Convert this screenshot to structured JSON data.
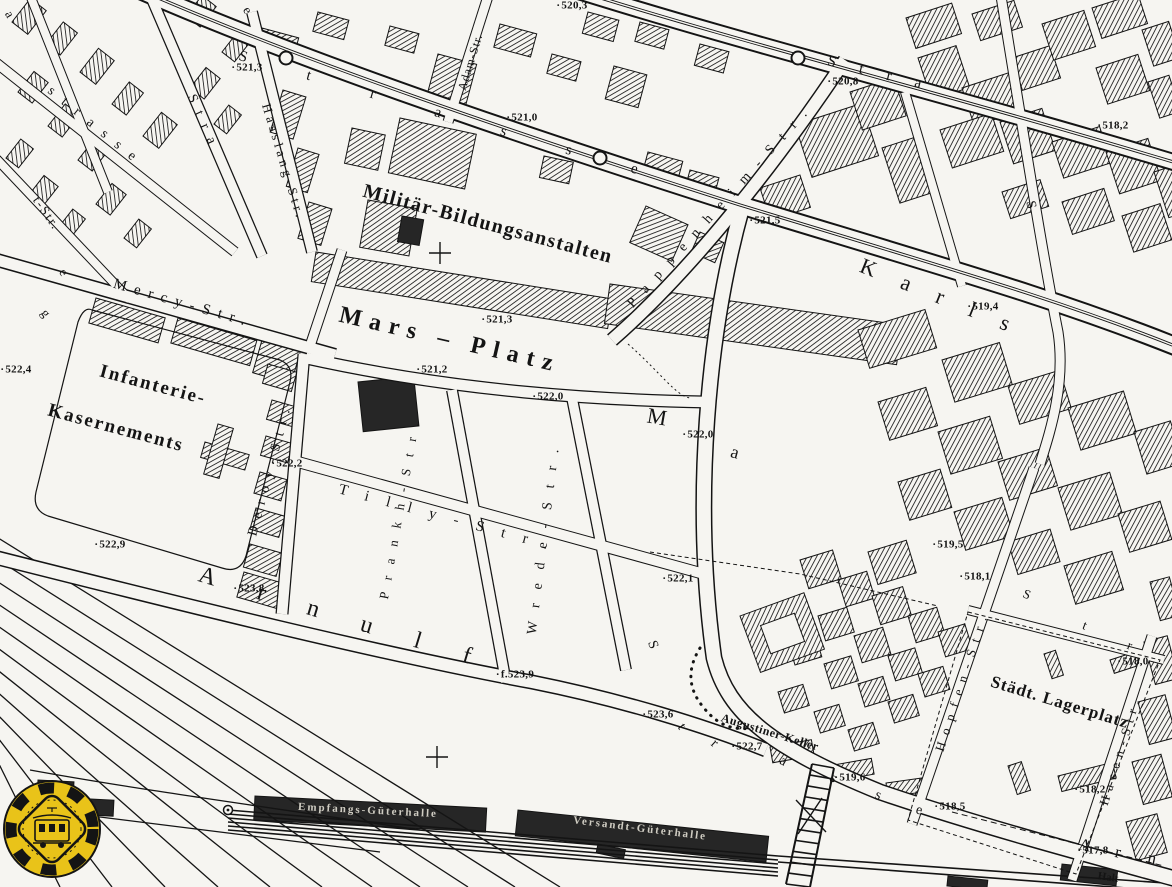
{
  "colors": {
    "paper": "#f6f5f1",
    "ink": "#141414",
    "building_hatch": "#1c1c1c",
    "dark_building": "#262626",
    "logo_yellow": "#e9c319"
  },
  "icons": {
    "badge": "tram-badge-logo",
    "stop": "tram-stop-circle",
    "cross": "cross-marker",
    "bridge": "rail-footbridge"
  },
  "labels": {
    "places": [
      {
        "text": "Militär-Bildungsanstalten",
        "x": 488,
        "y": 224,
        "r": 15,
        "size": 20,
        "sp": 1.5,
        "name": "label-militaer-bildungsanstalten"
      },
      {
        "text": "Mars – Platz",
        "x": 450,
        "y": 340,
        "r": 13,
        "size": 24,
        "sp": 8,
        "name": "label-mars-platz"
      },
      {
        "text": "Infanterie-",
        "x": 153,
        "y": 385,
        "r": 15,
        "size": 19,
        "sp": 2,
        "name": "label-infanterie"
      },
      {
        "text": "Kasernements",
        "x": 116,
        "y": 428,
        "r": 15,
        "size": 19,
        "sp": 2,
        "name": "label-kasernements"
      },
      {
        "text": "Städt. Lagerplatz",
        "x": 1060,
        "y": 702,
        "r": 17,
        "size": 17,
        "sp": 1,
        "name": "label-staedt-lagerplatz"
      },
      {
        "text": "Augustiner-Keller",
        "x": 770,
        "y": 732,
        "r": 17,
        "size": 12,
        "sp": 0.5,
        "name": "label-augustiner-keller"
      },
      {
        "text": "Halt",
        "x": 1108,
        "y": 878,
        "r": 8,
        "size": 11,
        "sp": 0,
        "name": "label-halt"
      }
    ],
    "streets": [
      {
        "text": "Mercy-Str.",
        "x": 183,
        "y": 304,
        "r": 16,
        "size": 15,
        "sp": 8,
        "name": "street-label-mercy-str"
      },
      {
        "text": "Hasslang-Str.",
        "x": 284,
        "y": 162,
        "r": 73,
        "size": 13,
        "sp": 4,
        "name": "street-label-hasslang-str"
      },
      {
        "text": "Adam-Str.",
        "x": 470,
        "y": 62,
        "r": -73,
        "size": 12,
        "sp": 1,
        "name": "street-label-adam-str"
      },
      {
        "text": "Deroy-Str.",
        "x": 271,
        "y": 469,
        "r": -75,
        "size": 14,
        "sp": 8,
        "name": "street-label-deroy-str"
      },
      {
        "text": "Tilly-Str.",
        "x": 452,
        "y": 520,
        "r": 15,
        "size": 15,
        "sp": 18,
        "name": "street-label-tilly-str"
      },
      {
        "text": "Prankh-Str.",
        "x": 400,
        "y": 505,
        "r": -80,
        "size": 13,
        "sp": 12,
        "name": "street-label-prankh-str"
      },
      {
        "text": "Wrede-Str.",
        "x": 545,
        "y": 535,
        "r": -83,
        "size": 14,
        "sp": 14,
        "name": "street-label-wrede-str"
      },
      {
        "text": "Pappenheim-Str.",
        "x": 722,
        "y": 205,
        "r": -48,
        "size": 14,
        "sp": 12,
        "name": "street-label-pappenheim-str"
      },
      {
        "text": "Arnulf",
        "x": 356,
        "y": 622,
        "r": 17,
        "size": 24,
        "sp": 44,
        "name": "street-label-arnulf"
      },
      {
        "text": "Hopfen-Str.",
        "x": 962,
        "y": 680,
        "r": -72,
        "size": 13,
        "sp": 8,
        "name": "street-label-hopfen-str"
      },
      {
        "text": "Hasen-Str.",
        "x": 1120,
        "y": 750,
        "r": -73,
        "size": 13,
        "sp": 6,
        "name": "street-label-hasen-str"
      },
      {
        "text": "Karls",
        "x": 948,
        "y": 300,
        "r": 22,
        "size": 22,
        "sp": 28,
        "name": "street-label-karls"
      },
      {
        "text": "Strasse",
        "x": 468,
        "y": 122,
        "r": 16,
        "size": 15,
        "sp": 62,
        "name": "street-label-strasse-top"
      },
      {
        "text": "Stra",
        "x": 886,
        "y": 76,
        "r": 14,
        "size": 15,
        "sp": 24,
        "name": "street-label-stra-right"
      },
      {
        "text": "strasse",
        "x": 96,
        "y": 128,
        "r": 39,
        "size": 14,
        "sp": 12,
        "name": "street-label-strasse-left"
      },
      {
        "text": "t-Str.",
        "x": 47,
        "y": 213,
        "r": 55,
        "size": 13,
        "sp": 2,
        "name": "street-label-t-str-partial"
      },
      {
        "text": "Stra",
        "x": 203,
        "y": 124,
        "r": 66,
        "size": 14,
        "sp": 10,
        "name": "street-label-stra-left2"
      }
    ],
    "letters": [
      {
        "text": "a",
        "x": 10,
        "y": 14,
        "r": 60,
        "size": 13
      },
      {
        "text": "e",
        "x": 248,
        "y": 10,
        "r": 60,
        "size": 13
      },
      {
        "text": "e",
        "x": 64,
        "y": 272,
        "r": 55,
        "size": 13
      },
      {
        "text": "g",
        "x": 46,
        "y": 313,
        "r": 55,
        "size": 13
      },
      {
        "text": "M",
        "x": 657,
        "y": 417,
        "r": 10,
        "size": 22
      },
      {
        "text": "a",
        "x": 735,
        "y": 452,
        "r": 15,
        "size": 18
      },
      {
        "text": "S",
        "x": 652,
        "y": 645,
        "r": 70,
        "size": 14
      },
      {
        "text": "t",
        "x": 681,
        "y": 727,
        "r": 55,
        "size": 14
      },
      {
        "text": "r",
        "x": 714,
        "y": 744,
        "r": 42,
        "size": 14
      },
      {
        "text": "a",
        "x": 783,
        "y": 762,
        "r": 30,
        "size": 14
      },
      {
        "text": "s",
        "x": 833,
        "y": 779,
        "r": 24,
        "size": 14
      },
      {
        "text": "s",
        "x": 878,
        "y": 796,
        "r": 20,
        "size": 14
      },
      {
        "text": "e",
        "x": 919,
        "y": 811,
        "r": 16,
        "size": 14
      },
      {
        "text": "A",
        "x": 1085,
        "y": 845,
        "r": 12,
        "size": 17
      },
      {
        "text": "r",
        "x": 1118,
        "y": 852,
        "r": 12,
        "size": 17
      },
      {
        "text": "n",
        "x": 1152,
        "y": 858,
        "r": 12,
        "size": 17
      },
      {
        "text": "S",
        "x": 1027,
        "y": 594,
        "r": 22,
        "size": 13
      },
      {
        "text": "t",
        "x": 1085,
        "y": 625,
        "r": 22,
        "size": 13
      },
      {
        "text": "r",
        "x": 1130,
        "y": 645,
        "r": 22,
        "size": 13
      },
      {
        "text": "S",
        "x": 1030,
        "y": 205,
        "r": 78,
        "size": 14
      }
    ],
    "halls": [
      {
        "text": "Empfangs-Güterhalle",
        "x": 368,
        "y": 811,
        "r": 3,
        "size": 11,
        "sp": 2,
        "name": "label-empfangs-gueterhalle"
      },
      {
        "text": "Versandt-Güterhalle",
        "x": 640,
        "y": 829,
        "r": 7,
        "size": 11,
        "sp": 2,
        "name": "label-versandt-gueterhalle"
      }
    ],
    "elevations": [
      {
        "value": "520,3",
        "x": 572,
        "y": 6
      },
      {
        "value": "521,3",
        "x": 247,
        "y": 68
      },
      {
        "value": "521,0",
        "x": 522,
        "y": 118
      },
      {
        "value": "520,8",
        "x": 843,
        "y": 82
      },
      {
        "value": "518,2",
        "x": 1113,
        "y": 126
      },
      {
        "value": "521,5",
        "x": 765,
        "y": 221
      },
      {
        "value": "519,4",
        "x": 983,
        "y": 307
      },
      {
        "value": "521,3",
        "x": 497,
        "y": 320
      },
      {
        "value": "521,2",
        "x": 432,
        "y": 370
      },
      {
        "value": "522,0",
        "x": 548,
        "y": 397
      },
      {
        "value": "522,4",
        "x": 16,
        "y": 370
      },
      {
        "value": "522,2",
        "x": 287,
        "y": 464
      },
      {
        "value": "522,0",
        "x": 698,
        "y": 435
      },
      {
        "value": "522,9",
        "x": 110,
        "y": 545
      },
      {
        "value": "519,5",
        "x": 948,
        "y": 545
      },
      {
        "value": "518,1",
        "x": 975,
        "y": 577
      },
      {
        "value": "523,8",
        "x": 249,
        "y": 589
      },
      {
        "value": "522,1",
        "x": 678,
        "y": 579
      },
      {
        "value": "518,0",
        "x": 1133,
        "y": 662
      },
      {
        "value": "523,6",
        "x": 658,
        "y": 715
      },
      {
        "value": "f.523,9",
        "x": 515,
        "y": 675
      },
      {
        "value": "522,7",
        "x": 747,
        "y": 747
      },
      {
        "value": "519,6",
        "x": 850,
        "y": 778
      },
      {
        "value": "518,2",
        "x": 1090,
        "y": 790
      },
      {
        "value": "518,5",
        "x": 950,
        "y": 807
      },
      {
        "value": "517,8",
        "x": 1093,
        "y": 851
      }
    ]
  }
}
